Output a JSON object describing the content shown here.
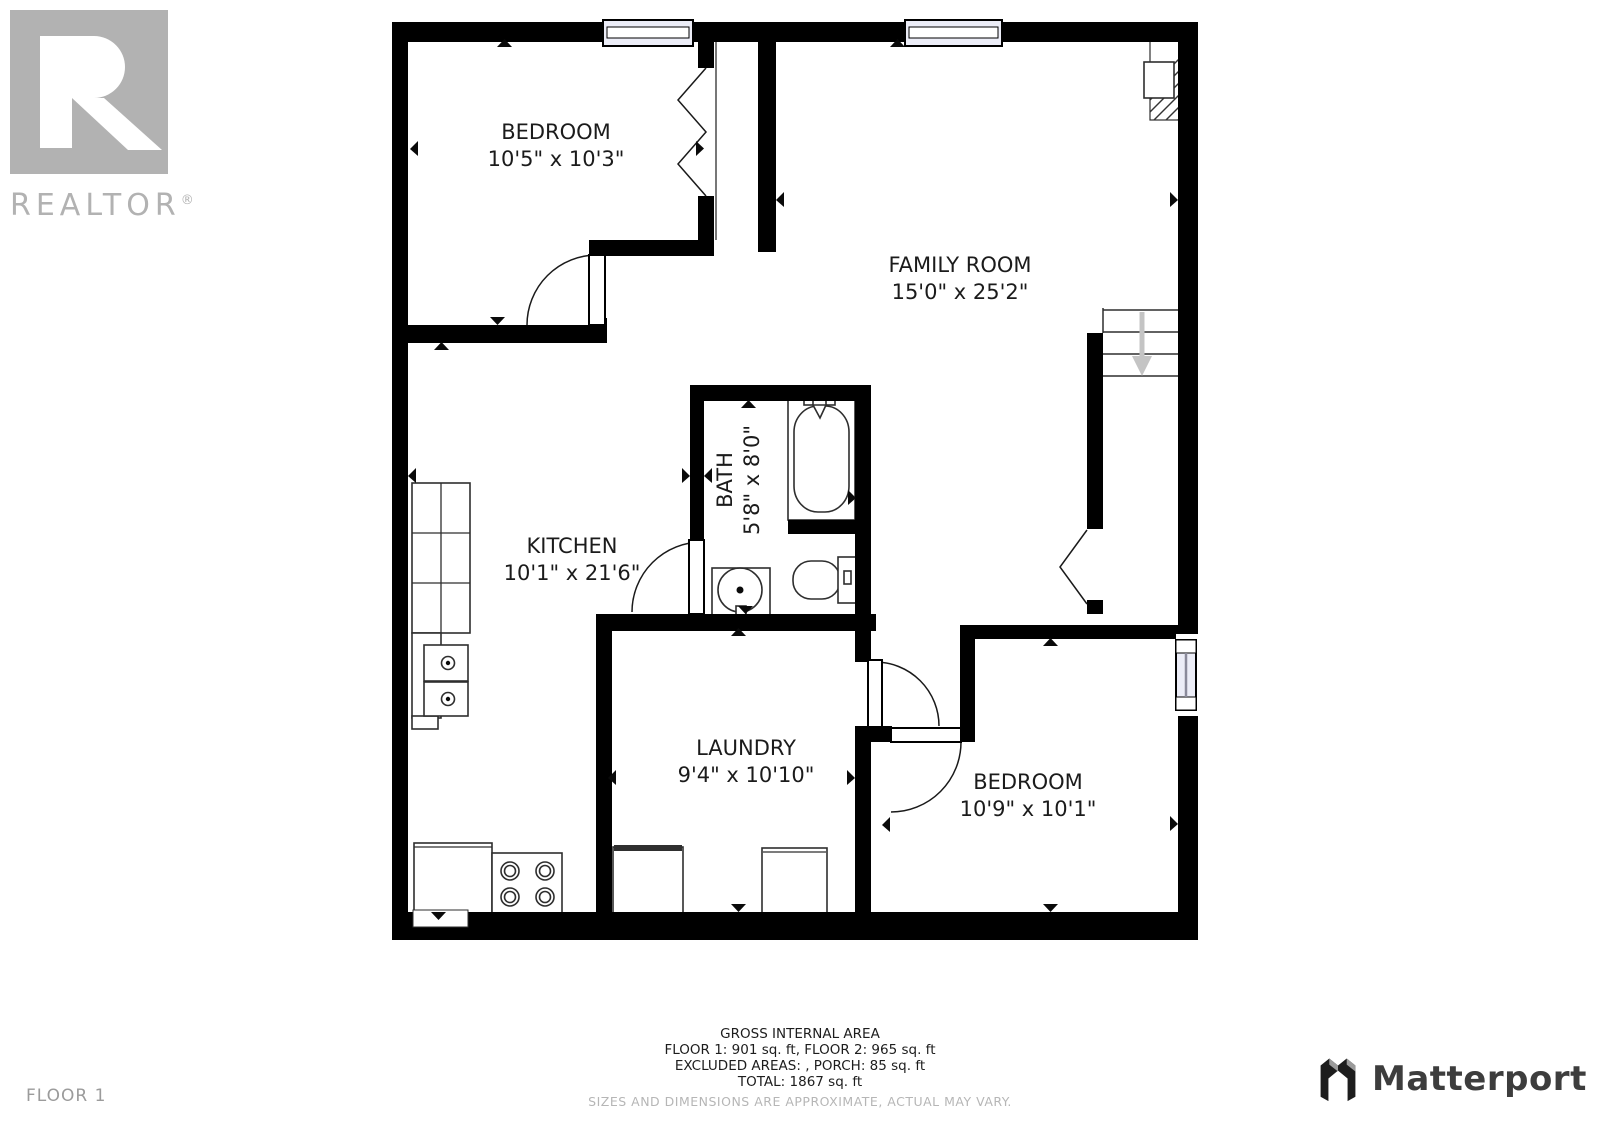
{
  "realtor_logo": {
    "letter": "R",
    "wordmark": "REALTOR",
    "registered": "®"
  },
  "matterport_logo": {
    "wordmark": "Matterport"
  },
  "floor_label": "FLOOR 1",
  "rooms": [
    {
      "name": "BEDROOM",
      "dims": "10'5\" x 10'3\""
    },
    {
      "name": "FAMILY ROOM",
      "dims": "15'0\" x 25'2\""
    },
    {
      "name": "BATH",
      "dims": "5'8\" x 8'0\""
    },
    {
      "name": "KITCHEN",
      "dims": "10'1\" x 21'6\""
    },
    {
      "name": "LAUNDRY",
      "dims": "9'4\" x 10'10\""
    },
    {
      "name": "BEDROOM",
      "dims": "10'9\" x 10'1\""
    }
  ],
  "area_summary": {
    "title": "GROSS INTERNAL AREA",
    "floors_line": "FLOOR 1: 901 sq. ft, FLOOR 2: 965 sq. ft",
    "excluded_line": "EXCLUDED AREAS: , PORCH: 85 sq. ft",
    "total_line": "TOTAL: 1867 sq. ft",
    "disclaimer": "SIZES AND DIMENSIONS ARE APPROXIMATE, ACTUAL MAY VARY."
  },
  "colors": {
    "wall": "#000000",
    "window_fill": "#ecedf7",
    "logo_gray": "#b2b2b2",
    "muted_text": "#b6b6b6",
    "floor_label_text": "#9b9b9b",
    "matterport_text": "#3d3d3d",
    "stair_arrow": "#c4c4c4"
  }
}
